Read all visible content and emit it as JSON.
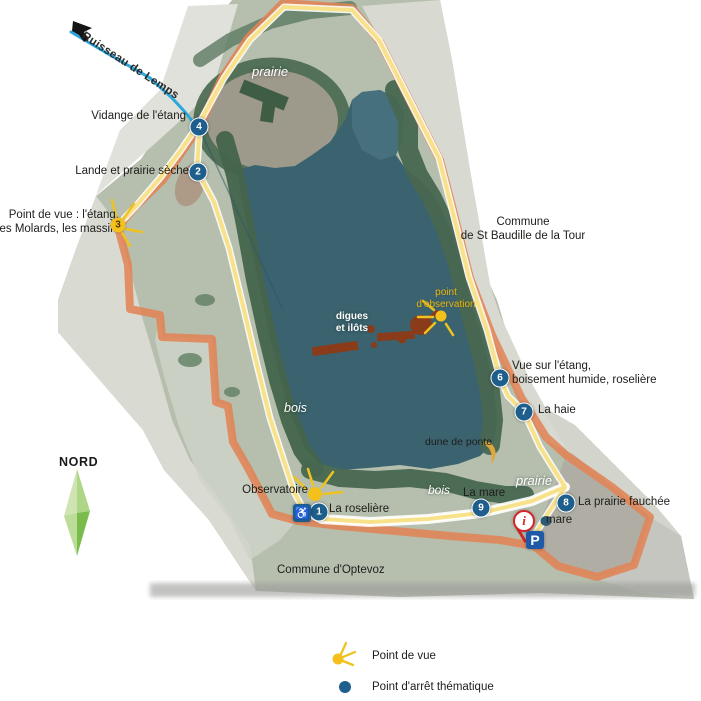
{
  "map_labels": {
    "stream": "Ruisseau de Lemps",
    "commune_right": [
      "Commune",
      "de St Baudille de la Tour"
    ],
    "commune_bottom": "Commune d'Optevoz",
    "north": "NORD",
    "viewpoint3": [
      "Point de vue : l'étang,",
      "les Molards, les massifs"
    ],
    "observation_point": [
      "point",
      "d'observation"
    ],
    "digues": [
      "digues",
      "et ilôts"
    ],
    "dune": "dune de ponte",
    "observatoire": "Observatoire",
    "small_mare": "mare",
    "habitat": {
      "prairie_top": "prairie",
      "bois_west": "bois",
      "bois_south": "bois",
      "prairie_se": "prairie"
    }
  },
  "stops": [
    {
      "num": "1",
      "label": "La roselière"
    },
    {
      "num": "2",
      "label": "Lande et prairie sèche"
    },
    {
      "num": "4",
      "label": "Vidange de l'étang"
    },
    {
      "num": "6",
      "label": "Vue sur l'étang,",
      "label2": "boisement humide, roselière"
    },
    {
      "num": "7",
      "label": "La haie"
    },
    {
      "num": "8",
      "label": "La prairie fauchée"
    },
    {
      "num": "9",
      "label": "La mare"
    }
  ],
  "viewpoint_num": "3",
  "icons": {
    "parking": "P",
    "info": "i",
    "wheelchair": "♿"
  },
  "legend": [
    {
      "icon": "sun-icon",
      "label": "Point de vue"
    },
    {
      "icon": "dot-icon",
      "label": "Point d'arrêt thématique"
    }
  ],
  "colors": {
    "trail_orange": "#e18457",
    "trail_yellow": "#f7e28a",
    "stream_blue": "#2ba7dc",
    "marker_blue": "#1d5e8c",
    "sun_yellow": "#f4c11c",
    "lake_teal": "#3a636f",
    "digues_brown": "#8a3b1a"
  }
}
